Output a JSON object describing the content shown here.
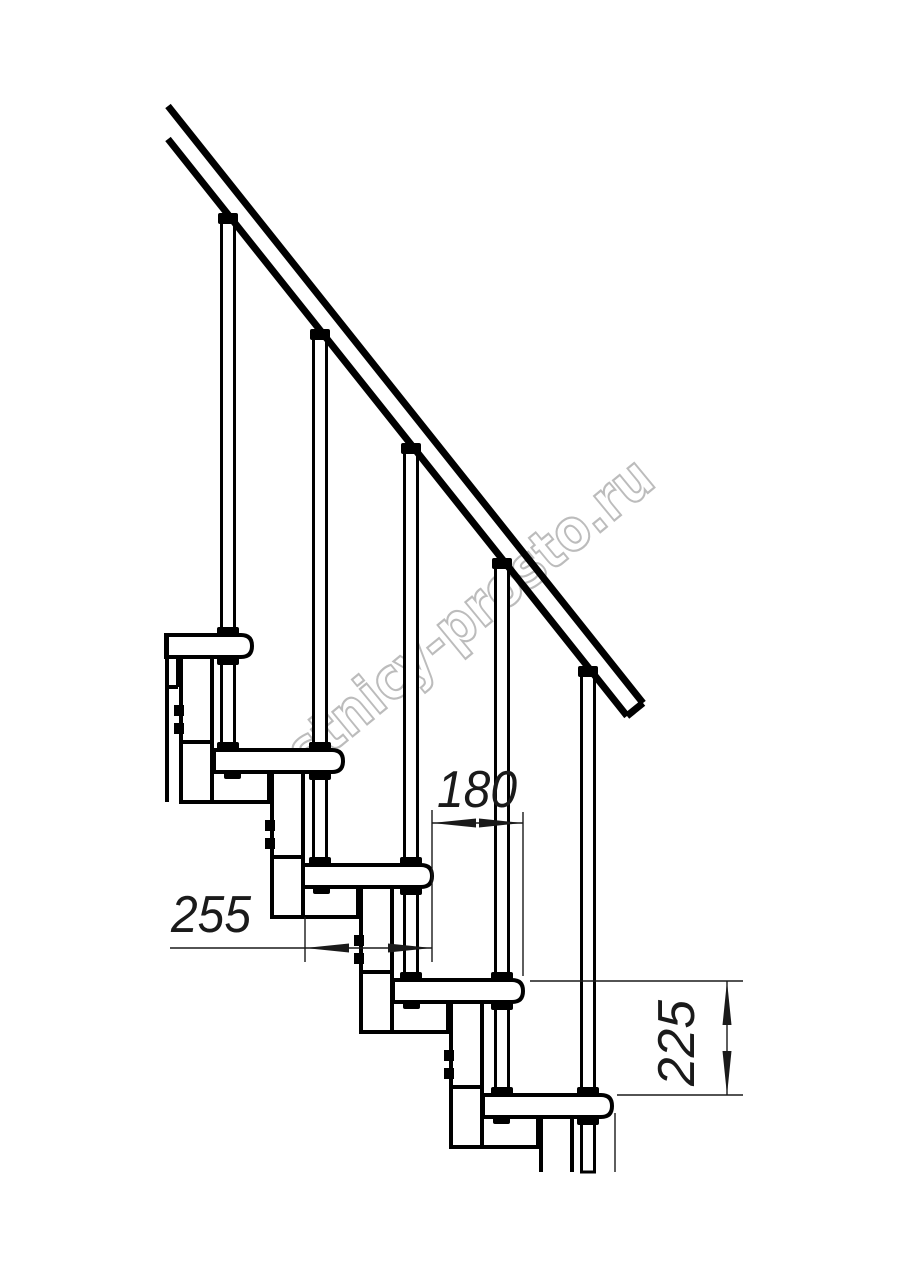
{
  "drawing": {
    "kind": "technical line drawing — modular staircase side elevation",
    "watermark_text": "lestnicy-prosto.ru",
    "annotations": {
      "step_run_label": "180",
      "tread_length_label": "255",
      "step_rise_label": "225"
    },
    "colors": {
      "line": "#000000",
      "background": "#ffffff",
      "watermark_outline": "#bcbcbc"
    }
  }
}
